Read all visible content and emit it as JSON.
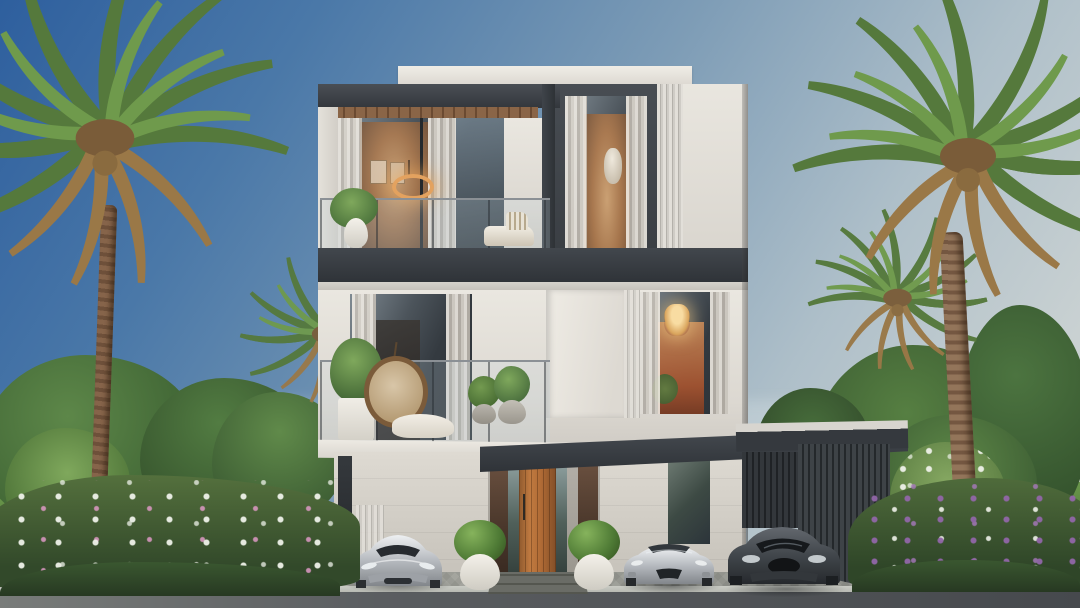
{
  "scene": {
    "type": "architectural-exterior-render",
    "subject": "modern three-storey villa with palm trees, landscaped garden, three sports cars and a carport",
    "sky": "clear daytime gradient"
  },
  "palette": {
    "sky_top": "#2e5f9e",
    "sky_mid": "#7d9cb6",
    "sky_horizon": "#c9d1d2",
    "wall_white": "#e8e5de",
    "wall_shadow": "#d4d0c9",
    "frame_dark": "#3c4147",
    "band_dark": "#33383e",
    "wood_soffit": "#7d5940",
    "door_wood": "#b5713a",
    "glass_dark": "#31373c",
    "curtain_cream": "#e9e2d8",
    "warm_glow": "#d79a62",
    "louver_light": "#e2dfd9",
    "green_dark": "#3c5c33",
    "green_mid": "#527c42",
    "green_light": "#7fa85c",
    "frond_dry": "#9a7847",
    "trunk_brown": "#86644a",
    "flower_pink": "#cf92bd",
    "flower_purple": "#9166a8",
    "flower_white": "#eef1e9",
    "grass_green": "#6f9c4c",
    "pavement_gray": "#b6b8b1",
    "driveway_gray": "#a0a19a",
    "road_gray": "#54575c",
    "car_silver": "#c0c4c8",
    "car_dark": "#4a4f54",
    "planter_white": "#efede6"
  },
  "objects": [
    "sky",
    "left-palm-tree",
    "right-palm-tree",
    "background-trees",
    "villa",
    "roof-parapet",
    "wood-slat-soffit",
    "upper-balcony",
    "pendant-ring-light",
    "lower-balcony",
    "hanging-egg-chair",
    "crystal-chandelier",
    "vertical-louvers",
    "entrance-canopy",
    "wood-entrance-door",
    "glass-sidelights",
    "boundary-wall",
    "driveway-gate",
    "carport",
    "silver-sports-car",
    "silver-convertible",
    "dark-sports-car",
    "potted-shrubs",
    "flower-beds",
    "lawn",
    "sidewalk",
    "road"
  ]
}
